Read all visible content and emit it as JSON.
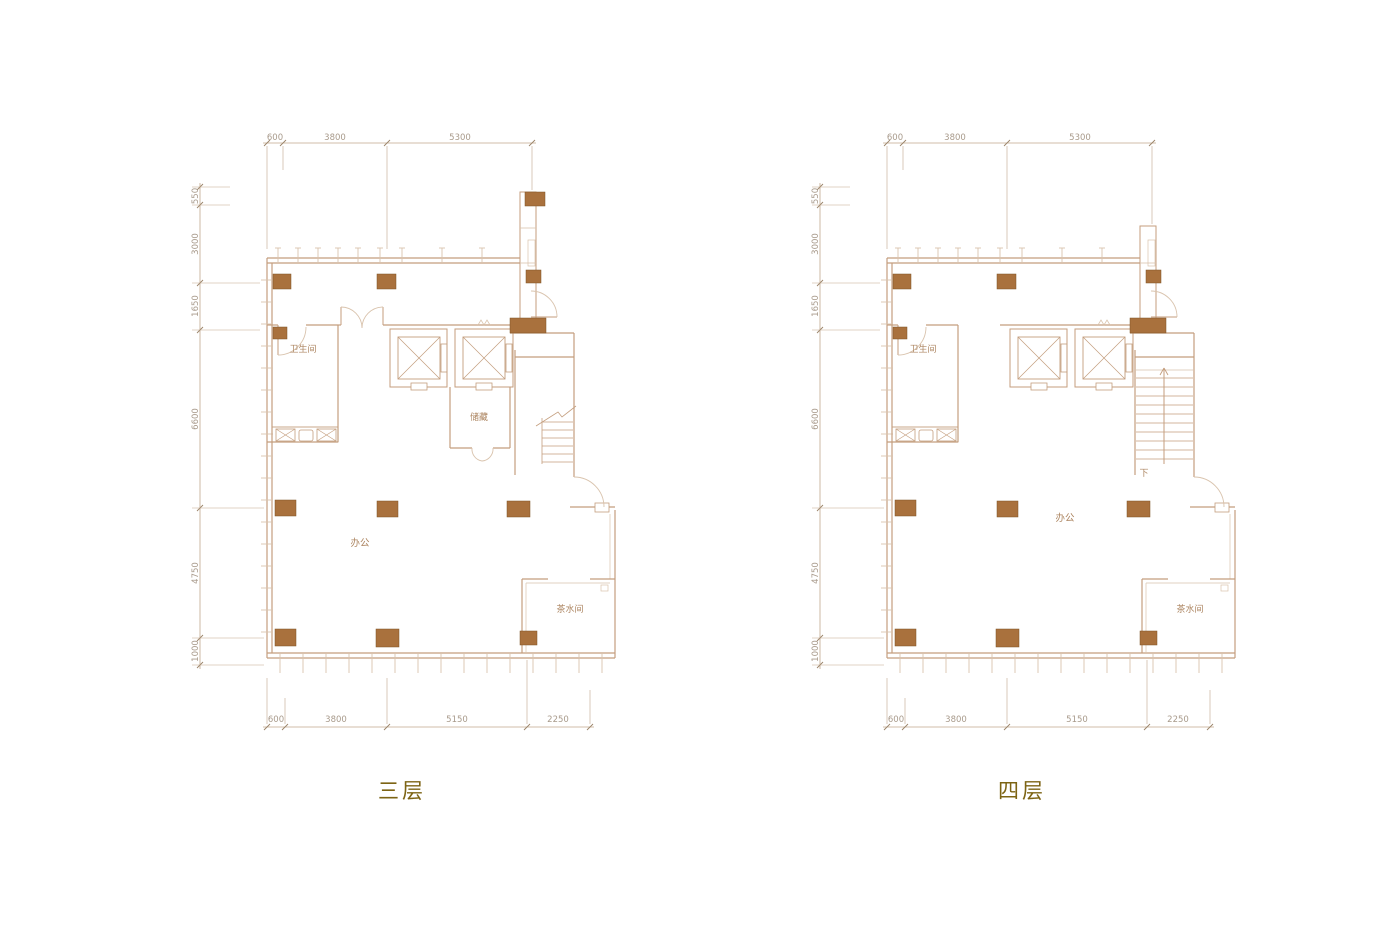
{
  "canvas": {
    "width": 1400,
    "height": 933,
    "background": "#ffffff"
  },
  "colors": {
    "wall": "#c49e7e",
    "wall_light": "#d9c3ad",
    "column_fill": "#a9713d",
    "column_stroke": "#7e5226",
    "dim_line": "#c2a78d",
    "dim_text": "#a89a8b",
    "room_text": "#ad8662",
    "title_text": "#7d6414"
  },
  "plans": [
    {
      "id": "third-floor",
      "title": "三层",
      "variant": "third",
      "dims_top": [
        "600",
        "3800",
        "5300"
      ],
      "dims_left": [
        "550",
        "3000",
        "1650",
        "6600",
        "4750",
        "1000"
      ],
      "dims_bottom": [
        "600",
        "3800",
        "5150",
        "2250"
      ],
      "rooms": [
        {
          "name": "bathroom",
          "label": "卫生间"
        },
        {
          "name": "storage",
          "label": "储藏"
        },
        {
          "name": "office",
          "label": "办公"
        },
        {
          "name": "tea-room",
          "label": "茶水间"
        }
      ]
    },
    {
      "id": "fourth-floor",
      "title": "四层",
      "variant": "fourth",
      "dims_top": [
        "600",
        "3800",
        "5300"
      ],
      "dims_left": [
        "550",
        "3000",
        "1650",
        "6600",
        "4750",
        "1000"
      ],
      "dims_bottom": [
        "600",
        "3800",
        "5150",
        "2250"
      ],
      "rooms": [
        {
          "name": "bathroom",
          "label": "卫生间"
        },
        {
          "name": "office",
          "label": "办公"
        },
        {
          "name": "tea-room",
          "label": "茶水间"
        },
        {
          "name": "stair-down",
          "label": "下"
        }
      ]
    }
  ]
}
